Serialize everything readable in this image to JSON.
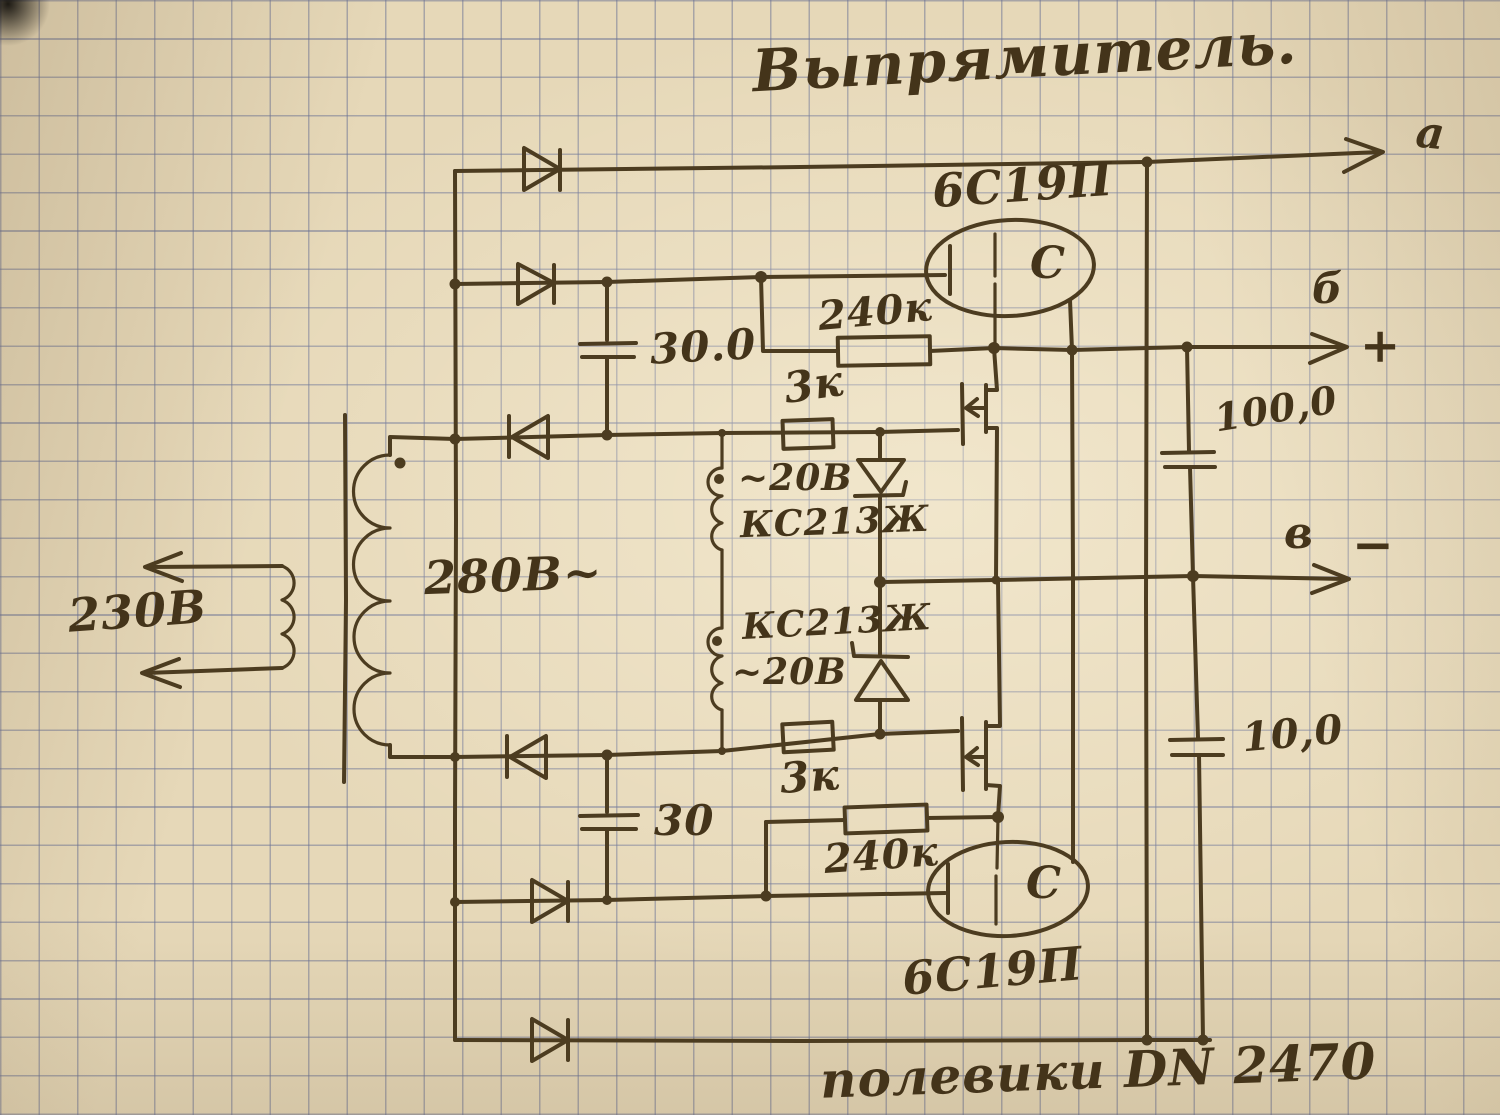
{
  "title": "Выпрямитель.",
  "outputs": {
    "top_label": "а",
    "plus_label": "б",
    "plus_sign": "+",
    "mid_label": "в",
    "minus_sign": "−"
  },
  "transformer": {
    "primary_voltage": "230В",
    "secondary_voltage": "280В~"
  },
  "tubes": {
    "top_type": "6С19П",
    "bottom_type": "6С19П",
    "top_electrode": "С",
    "bottom_electrode": "С"
  },
  "resistors": {
    "top_240k": "240к",
    "top_3k": "3к",
    "bottom_3k": "3к",
    "bottom_240k": "240к"
  },
  "zeners": {
    "top_voltage": "~20В",
    "top_type": "КС213Ж",
    "bottom_type": "КС213Ж",
    "bottom_voltage": "~20В"
  },
  "capacitors": {
    "top_filter": "30.0",
    "bottom_filter": "30",
    "plus_rail": "100,0",
    "minus_rail": "10,0"
  },
  "note": "полевики  DN 2470",
  "ink_color": "#4c3c20",
  "paper_color": "#e6d8b8",
  "grid_color": "#6870a8"
}
